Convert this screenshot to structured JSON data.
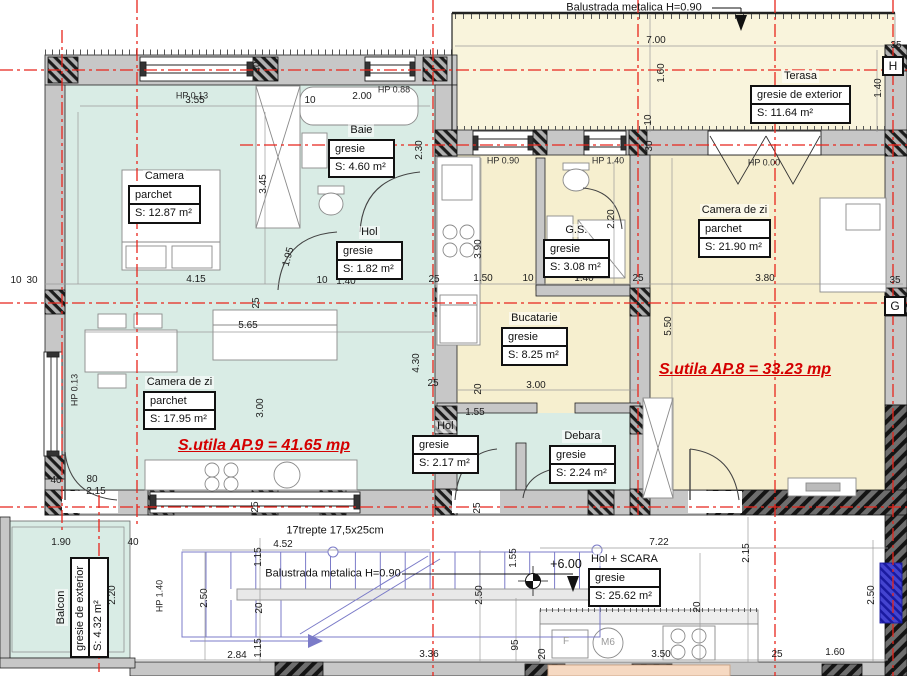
{
  "colors": {
    "floor_ap9_teal": "#d9ece5",
    "floor_ap8_yellow": "#f6efcf",
    "floor_terasa": "#f9f4dc",
    "wall_gray": "#c7c7c7",
    "axis_red": "#e8251c",
    "stair_blue": "#7b7bc8",
    "table_peach": "#f6d9c2",
    "total_red": "#d40000",
    "window_blue": "#2222cc"
  },
  "annotations": {
    "balustrade_top": "Balustrada metalica H=0.90",
    "balustrade_stairs": "Balustrada metalica H=0.90",
    "stairs_note": "17trepte 17,5x25cm",
    "level_mark": "+6.00",
    "ap9_total": "S.utila AP.9 = 41.65 mp",
    "ap8_total": "S.utila AP.8 = 33.23 mp"
  },
  "rooms": [
    {
      "name": "Camera",
      "finish": "parchet",
      "area": "S: 12.87 m²",
      "x": 128,
      "y": 170
    },
    {
      "name": "Baie",
      "finish": "gresie",
      "area": "S: 4.60 m²",
      "x": 328,
      "y": 124
    },
    {
      "name": "Hol",
      "finish": "gresie",
      "area": "S: 1.82 m²",
      "x": 336,
      "y": 226
    },
    {
      "name": "Camera de zi",
      "finish": "parchet",
      "area": "S: 17.95 m²",
      "x": 143,
      "y": 376
    },
    {
      "name": "Terasa",
      "finish": "gresie de exterior",
      "area": "S:      11.64 m²",
      "x": 750,
      "y": 70
    },
    {
      "name": "G.S.",
      "finish": "gresie",
      "area": "S: 3.08 m²",
      "x": 543,
      "y": 224
    },
    {
      "name": "Bucatarie",
      "finish": "gresie",
      "area": "S: 8.25 m²",
      "x": 501,
      "y": 312
    },
    {
      "name": "Camera de zi",
      "finish": "parchet",
      "area": "S: 21.90 m²",
      "x": 698,
      "y": 204
    },
    {
      "name": "Hol",
      "finish": "gresie",
      "area": "S: 2.17 m²",
      "x": 412,
      "y": 420
    },
    {
      "name": "Debara",
      "finish": "gresie",
      "area": "S: 2.24 m²",
      "x": 549,
      "y": 430
    },
    {
      "name": "Hol + SCARA",
      "finish": "gresie",
      "area": "S: 25.62 m²",
      "x": 588,
      "y": 553
    },
    {
      "name": "Balcon",
      "finish": "gresie de exterior",
      "area": "S:   4.32 m²",
      "x": 55,
      "y": 658,
      "rot": -90
    }
  ],
  "hp_labels": [
    {
      "t": "HP 0.13",
      "x": 192,
      "y": 96
    },
    {
      "t": "HP 0.88",
      "x": 394,
      "y": 90
    },
    {
      "t": "HP 0.90",
      "x": 503,
      "y": 161
    },
    {
      "t": "HP 1.40",
      "x": 608,
      "y": 161
    },
    {
      "t": "HP 0.00",
      "x": 764,
      "y": 163
    },
    {
      "t": "HP 0.13",
      "x": 75,
      "y": 390,
      "r": -90
    },
    {
      "t": "HP 1.40",
      "x": 160,
      "y": 596,
      "r": -90
    }
  ],
  "dimensions": [
    {
      "t": "3.55",
      "x": 195,
      "y": 101
    },
    {
      "t": "10",
      "x": 310,
      "y": 101
    },
    {
      "t": "2.00",
      "x": 362,
      "y": 97
    },
    {
      "t": "40",
      "x": 258,
      "y": 67,
      "r": -90
    },
    {
      "t": "3.45",
      "x": 264,
      "y": 184,
      "r": -90
    },
    {
      "t": "2.30",
      "x": 420,
      "y": 150,
      "r": -90
    },
    {
      "t": "1.95",
      "x": 289,
      "y": 257,
      "r": -75
    },
    {
      "t": "10",
      "x": 16,
      "y": 281
    },
    {
      "t": "30",
      "x": 32,
      "y": 281
    },
    {
      "t": "4.15",
      "x": 196,
      "y": 280
    },
    {
      "t": "10",
      "x": 322,
      "y": 281
    },
    {
      "t": "1.40",
      "x": 346,
      "y": 282
    },
    {
      "t": "25",
      "x": 434,
      "y": 280
    },
    {
      "t": "1.50",
      "x": 483,
      "y": 279
    },
    {
      "t": "10",
      "x": 528,
      "y": 279
    },
    {
      "t": "1.40",
      "x": 584,
      "y": 279
    },
    {
      "t": "25",
      "x": 638,
      "y": 279
    },
    {
      "t": "3.80",
      "x": 765,
      "y": 279
    },
    {
      "t": "35",
      "x": 895,
      "y": 281
    },
    {
      "t": "25",
      "x": 257,
      "y": 303,
      "r": -90
    },
    {
      "t": "25",
      "x": 256,
      "y": 507,
      "r": -90
    },
    {
      "t": "25",
      "x": 478,
      "y": 508,
      "r": -90
    },
    {
      "t": "5.65",
      "x": 248,
      "y": 326
    },
    {
      "t": "3.00",
      "x": 261,
      "y": 408,
      "r": -90
    },
    {
      "t": "4.30",
      "x": 417,
      "y": 363,
      "r": -90
    },
    {
      "t": "25",
      "x": 433,
      "y": 384
    },
    {
      "t": "40",
      "x": 56,
      "y": 481
    },
    {
      "t": "80",
      "x": 92,
      "y": 480
    },
    {
      "t": "2.15",
      "x": 96,
      "y": 492
    },
    {
      "t": "3.90",
      "x": 479,
      "y": 249,
      "r": -90
    },
    {
      "t": "2.20",
      "x": 612,
      "y": 219,
      "r": -90
    },
    {
      "t": "5.50",
      "x": 669,
      "y": 326,
      "r": -90
    },
    {
      "t": "3.00",
      "x": 536,
      "y": 386
    },
    {
      "t": "20",
      "x": 479,
      "y": 389,
      "r": -90
    },
    {
      "t": "1.55",
      "x": 475,
      "y": 413
    },
    {
      "t": "7.00",
      "x": 656,
      "y": 41
    },
    {
      "t": "1.60",
      "x": 662,
      "y": 73,
      "r": -90
    },
    {
      "t": "10",
      "x": 649,
      "y": 120,
      "r": -90
    },
    {
      "t": "30",
      "x": 650,
      "y": 146,
      "r": -90
    },
    {
      "t": "35",
      "x": 896,
      "y": 46
    },
    {
      "t": "1.40",
      "x": 879,
      "y": 88,
      "r": -90
    },
    {
      "t": "1.90",
      "x": 61,
      "y": 543
    },
    {
      "t": "40",
      "x": 133,
      "y": 543
    },
    {
      "t": "2.20",
      "x": 113,
      "y": 595,
      "r": -90
    },
    {
      "t": "1.15",
      "x": 259,
      "y": 557,
      "r": -90
    },
    {
      "t": "2.50",
      "x": 205,
      "y": 598,
      "r": -90
    },
    {
      "t": "20",
      "x": 260,
      "y": 608,
      "r": -90
    },
    {
      "t": "1.15",
      "x": 259,
      "y": 648,
      "r": -90
    },
    {
      "t": "2.84",
      "x": 237,
      "y": 656
    },
    {
      "t": "3.36",
      "x": 429,
      "y": 655
    },
    {
      "t": "4.52",
      "x": 283,
      "y": 545
    },
    {
      "t": "7.22",
      "x": 659,
      "y": 543
    },
    {
      "t": "2.15",
      "x": 747,
      "y": 553,
      "r": -90
    },
    {
      "t": "1.55",
      "x": 514,
      "y": 558,
      "r": -90
    },
    {
      "t": "2.50",
      "x": 480,
      "y": 595,
      "r": -90
    },
    {
      "t": "95",
      "x": 516,
      "y": 645,
      "r": -90
    },
    {
      "t": "20",
      "x": 543,
      "y": 654,
      "r": -90
    },
    {
      "t": "20",
      "x": 698,
      "y": 607,
      "r": -90
    },
    {
      "t": "3.50",
      "x": 661,
      "y": 655
    },
    {
      "t": "25",
      "x": 777,
      "y": 655
    },
    {
      "t": "1.60",
      "x": 835,
      "y": 653
    },
    {
      "t": "2.50",
      "x": 872,
      "y": 595,
      "r": -90
    }
  ],
  "appliance_labels": [
    {
      "t": "F",
      "x": 566,
      "y": 642
    },
    {
      "t": "M6",
      "x": 608,
      "y": 643
    }
  ],
  "grid": {
    "vertical": [
      {
        "x": 62,
        "y1": 30,
        "y2": 530
      },
      {
        "x": 99,
        "y1": 495,
        "y2": 672
      },
      {
        "x": 137,
        "y1": 0,
        "y2": 528
      },
      {
        "x": 433,
        "y1": 0,
        "y2": 676
      },
      {
        "x": 638,
        "y1": 0,
        "y2": 515
      },
      {
        "x": 775,
        "y1": 0,
        "y2": 676
      },
      {
        "x": 893,
        "y1": 0,
        "y2": 676
      }
    ],
    "horizontal": [
      {
        "y": 70,
        "x1": 0,
        "x2": 907
      },
      {
        "y": 145,
        "x1": 240,
        "x2": 907
      },
      {
        "y": 303,
        "x1": 0,
        "x2": 907
      },
      {
        "y": 507,
        "x1": 0,
        "x2": 907
      }
    ],
    "letters": [
      {
        "t": "H",
        "x": 893,
        "y": 66
      },
      {
        "t": "G",
        "x": 895,
        "y": 306
      }
    ]
  }
}
